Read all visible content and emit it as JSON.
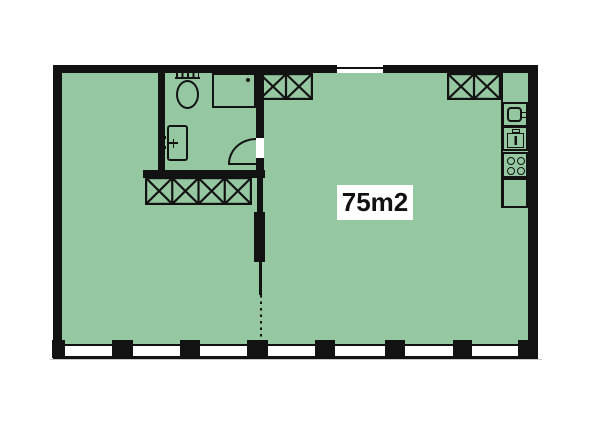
{
  "floor_plan": {
    "area_label": "75m2",
    "colors": {
      "page": "#ffffff",
      "floor": "#95c7a1",
      "wall": "#121212",
      "window": "#ffffff",
      "label_bg": "#ffffff",
      "label_text": "#111111",
      "shadow": "#c8c8c8"
    },
    "icons": [
      "toilet-icon",
      "shower-icon",
      "washbasin-icon",
      "kitchen-sink-icon",
      "oven-icon",
      "stove-icon",
      "cabinet-icon",
      "closet-x-icon",
      "door-swing-icon"
    ],
    "window_count": 7,
    "entrance_side": "top"
  }
}
